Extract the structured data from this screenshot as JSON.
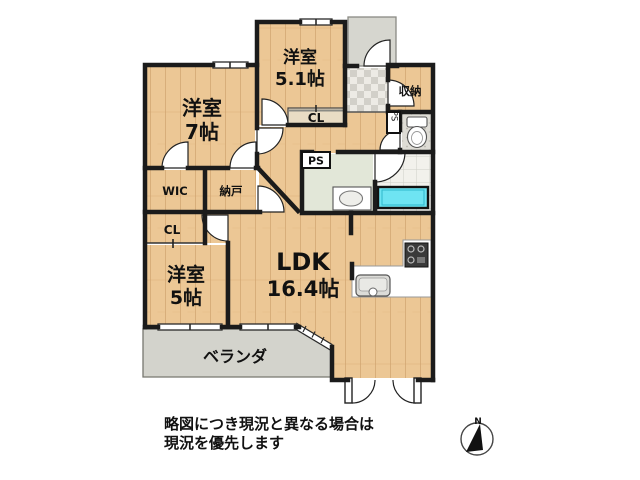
{
  "floorplan": {
    "rooms": {
      "western_room_51": {
        "line1": "洋室",
        "line2": "5.1帖"
      },
      "western_room_7": {
        "line1": "洋室",
        "line2": "7帖"
      },
      "western_room_5": {
        "line1": "洋室",
        "line2": "5帖"
      },
      "ldk": {
        "line1": "LDK",
        "line2": "16.4帖"
      },
      "storage": {
        "label": "収納"
      },
      "closet_upper": {
        "label": "CL"
      },
      "closet_lower": {
        "label": "CL"
      },
      "walk_in_closet": {
        "label": "WIC"
      },
      "storeroom": {
        "label": "納戸"
      },
      "pipe_space_toilet": {
        "label": "PS"
      },
      "pipe_space_washroom": {
        "label": "PS"
      },
      "veranda": {
        "label": "ベランダ"
      }
    },
    "disclaimer": {
      "line1": "略図につき現況と異なる場合は",
      "line2": "現況を優先します"
    },
    "compass": {
      "north": "N"
    },
    "colors": {
      "wood": "#ecc795",
      "wall": "#1b1b1b",
      "veranda_gray": "#d3d3cc",
      "washroom_green": "#e2e7d8",
      "bathtub_cyan": "#6ee4f2",
      "entrance_tile": "#d2d0c9"
    }
  }
}
